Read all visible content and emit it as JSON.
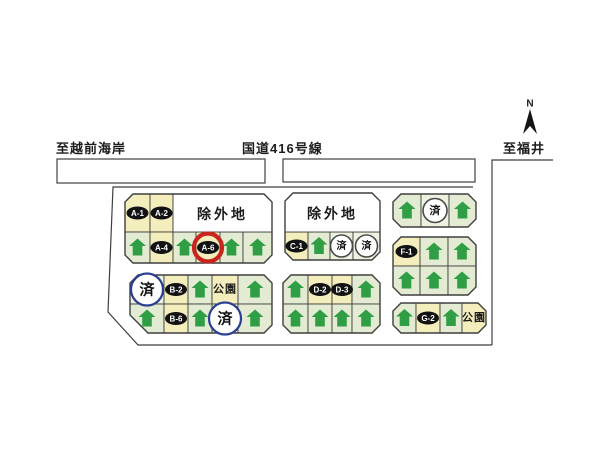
{
  "map": {
    "compass": {
      "label": "N",
      "x": 530,
      "y": 104
    },
    "road_labels": [
      {
        "id": "to-echizen-coast",
        "text": "至越前海岸",
        "x": 56,
        "y": 138
      },
      {
        "id": "route-416",
        "text": "国道416号線",
        "x": 242,
        "y": 138
      },
      {
        "id": "to-fukui",
        "text": "至福井",
        "x": 503,
        "y": 138
      }
    ],
    "texts": {
      "excluded": "除外地",
      "park": "公園",
      "sold": "済"
    },
    "highlighted_lot": "A-6",
    "colors": {
      "line": "#3f3f3f",
      "lot_green": "#e4ebd3",
      "lot_cream": "#f4eebd",
      "sold_cell": "#edf2e0",
      "exclusion_white": "#ffffff",
      "house_green": "#2f9e44",
      "oval_black": "#121212",
      "ring_blue": "#2b3f93",
      "ring_dark": "#4a4a4a",
      "ring_red": "#c9251f",
      "text_dark": "#1c1c1c"
    },
    "road_strips": [
      {
        "x": 57,
        "y": 159,
        "w": 208,
        "h": 24
      },
      {
        "x": 283,
        "y": 159,
        "w": 192,
        "h": 23
      }
    ],
    "right_road_path": "M553 160 L492 160 L492 345",
    "site_boundary_path": "M473 187 L113 187 L108 312 L138 345 L492 345",
    "blocks": [
      {
        "id": "A",
        "x": 125,
        "y": 194,
        "w": 147,
        "h": 69,
        "ch": [
          8,
          8,
          8,
          8
        ],
        "exclusions": [
          {
            "x": 173,
            "y": 194,
            "w": 99,
            "h": 38
          }
        ],
        "rows": [
          {
            "y": 194,
            "h": 38,
            "cells": [
              {
                "x": 125,
                "w": 25,
                "t": "label",
                "txt": "A-1"
              },
              {
                "x": 150,
                "w": 23,
                "t": "label",
                "txt": "A-2"
              }
            ]
          },
          {
            "y": 232,
            "h": 31,
            "cells": [
              {
                "x": 125,
                "w": 25,
                "t": "house"
              },
              {
                "x": 150,
                "w": 23,
                "t": "label",
                "txt": "A-4"
              },
              {
                "x": 173,
                "w": 23,
                "t": "house"
              },
              {
                "x": 196,
                "w": 24,
                "t": "label",
                "txt": "A-6",
                "ring": "red",
                "r": 14
              },
              {
                "x": 220,
                "w": 23,
                "t": "house"
              },
              {
                "x": 243,
                "w": 29,
                "t": "house"
              }
            ]
          }
        ]
      },
      {
        "id": "B",
        "x": 130,
        "y": 275,
        "w": 142,
        "h": 58,
        "ch": [
          8,
          8,
          8,
          18
        ],
        "rows": [
          {
            "y": 275,
            "h": 29,
            "cells": [
              {
                "x": 130,
                "w": 34,
                "t": "sold",
                "ring": "blue",
                "r": 16
              },
              {
                "x": 164,
                "w": 24,
                "t": "label",
                "txt": "B-2"
              },
              {
                "x": 188,
                "w": 24,
                "t": "house"
              },
              {
                "x": 212,
                "w": 26,
                "t": "park"
              },
              {
                "x": 238,
                "w": 34,
                "t": "house"
              }
            ]
          },
          {
            "y": 304,
            "h": 29,
            "cells": [
              {
                "x": 130,
                "w": 34,
                "t": "house"
              },
              {
                "x": 164,
                "w": 24,
                "t": "label",
                "txt": "B-6"
              },
              {
                "x": 188,
                "w": 24,
                "t": "house"
              },
              {
                "x": 212,
                "w": 26,
                "t": "sold",
                "ring": "blue",
                "r": 16
              },
              {
                "x": 238,
                "w": 34,
                "t": "house"
              }
            ]
          }
        ]
      },
      {
        "id": "C",
        "x": 285,
        "y": 193,
        "w": 95,
        "h": 67,
        "ch": [
          8,
          8,
          8,
          8
        ],
        "exclusions": [
          {
            "x": 285,
            "y": 193,
            "w": 95,
            "h": 39
          }
        ],
        "rows": [
          {
            "y": 232,
            "h": 28,
            "cells": [
              {
                "x": 285,
                "w": 23,
                "t": "label",
                "txt": "C-1"
              },
              {
                "x": 308,
                "w": 22,
                "t": "house"
              },
              {
                "x": 330,
                "w": 23,
                "t": "sold",
                "ring": "dark",
                "r": 11
              },
              {
                "x": 353,
                "w": 27,
                "t": "sold",
                "ring": "dark",
                "r": 11
              }
            ]
          }
        ]
      },
      {
        "id": "D",
        "x": 283,
        "y": 275,
        "w": 97,
        "h": 58,
        "ch": [
          8,
          8,
          8,
          8
        ],
        "rows": [
          {
            "y": 275,
            "h": 29,
            "cells": [
              {
                "x": 283,
                "w": 25,
                "t": "house"
              },
              {
                "x": 308,
                "w": 24,
                "t": "label",
                "txt": "D-2"
              },
              {
                "x": 332,
                "w": 20,
                "t": "label",
                "txt": "D-3"
              },
              {
                "x": 352,
                "w": 28,
                "t": "house"
              }
            ]
          },
          {
            "y": 304,
            "h": 29,
            "cells": [
              {
                "x": 283,
                "w": 25,
                "t": "house"
              },
              {
                "x": 308,
                "w": 24,
                "t": "house"
              },
              {
                "x": 332,
                "w": 20,
                "t": "house"
              },
              {
                "x": 352,
                "w": 28,
                "t": "house"
              }
            ]
          }
        ]
      },
      {
        "id": "E",
        "x": 393,
        "y": 194,
        "w": 83,
        "h": 33,
        "ch": [
          8,
          8,
          8,
          8
        ],
        "rows": [
          {
            "y": 194,
            "h": 33,
            "cells": [
              {
                "x": 393,
                "w": 28,
                "t": "house"
              },
              {
                "x": 421,
                "w": 28,
                "t": "sold",
                "ring": "dark",
                "r": 12
              },
              {
                "x": 449,
                "w": 27,
                "t": "house"
              }
            ]
          }
        ]
      },
      {
        "id": "F",
        "x": 393,
        "y": 237,
        "w": 83,
        "h": 58,
        "ch": [
          8,
          8,
          8,
          8
        ],
        "rows": [
          {
            "y": 237,
            "h": 29,
            "cells": [
              {
                "x": 393,
                "w": 27,
                "t": "label",
                "txt": "F-1"
              },
              {
                "x": 420,
                "w": 28,
                "t": "house"
              },
              {
                "x": 448,
                "w": 28,
                "t": "house"
              }
            ]
          },
          {
            "y": 266,
            "h": 29,
            "cells": [
              {
                "x": 393,
                "w": 27,
                "t": "house"
              },
              {
                "x": 420,
                "w": 28,
                "t": "house"
              },
              {
                "x": 448,
                "w": 28,
                "t": "house"
              }
            ]
          }
        ]
      },
      {
        "id": "G",
        "x": 393,
        "y": 303,
        "w": 93,
        "h": 30,
        "ch": [
          8,
          8,
          8,
          8
        ],
        "rows": [
          {
            "y": 303,
            "h": 30,
            "cells": [
              {
                "x": 393,
                "w": 23,
                "t": "house"
              },
              {
                "x": 416,
                "w": 24,
                "t": "label",
                "txt": "G-2"
              },
              {
                "x": 440,
                "w": 22,
                "t": "house"
              },
              {
                "x": 462,
                "w": 24,
                "t": "park"
              }
            ]
          }
        ]
      }
    ]
  }
}
